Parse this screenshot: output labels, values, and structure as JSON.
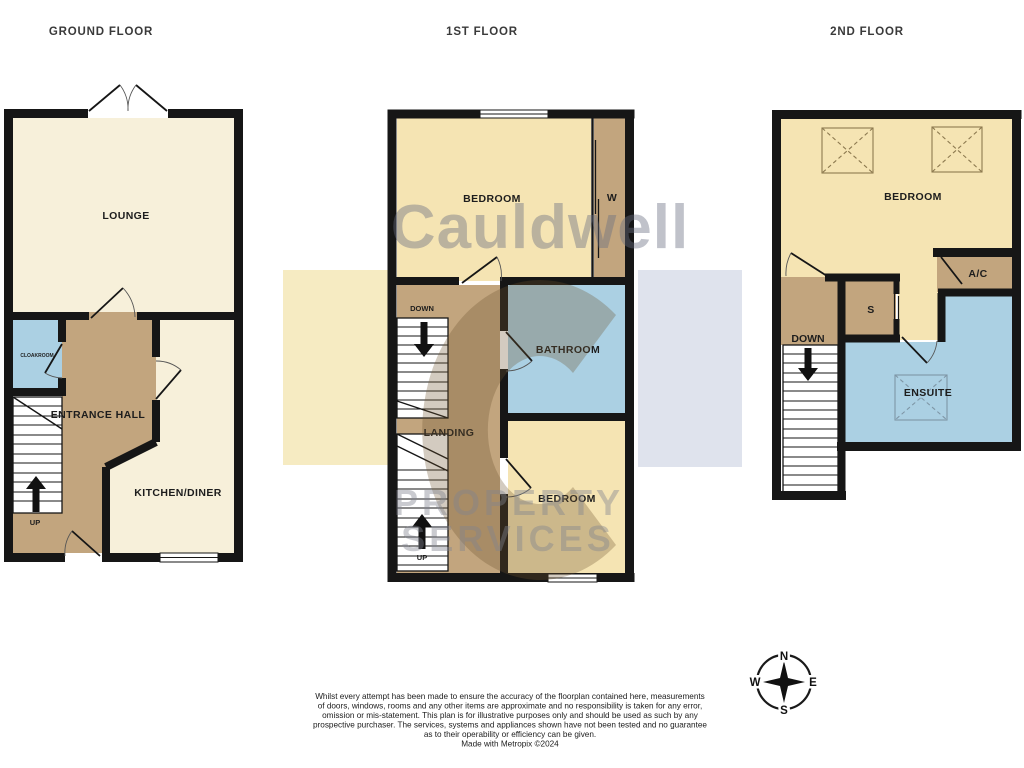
{
  "headers": [
    {
      "label": "GROUND FLOOR"
    },
    {
      "label": "1ST FLOOR"
    },
    {
      "label": "2ND FLOOR"
    }
  ],
  "ground_floor": {
    "lounge": "LOUNGE",
    "cloakroom": "CLOAKROOM",
    "entrance_hall": "ENTRANCE HALL",
    "kitchen_diner": "KITCHEN/DINER",
    "stairs_up": "UP"
  },
  "first_floor": {
    "bedroom_front": "BEDROOM",
    "wardrobe": "W",
    "stairs_down": "DOWN",
    "bathroom": "BATHROOM",
    "landing": "LANDING",
    "bedroom_rear": "BEDROOM",
    "stairs_up": "UP"
  },
  "second_floor": {
    "bedroom": "BEDROOM",
    "air_conditioning": "A/C",
    "store": "S",
    "stairs_down": "DOWN",
    "ensuite": "ENSUITE"
  },
  "watermark": {
    "brand": "Cauldwell",
    "word_top": "PROPERTY",
    "word_bottom": "SERVICES"
  },
  "compass": {
    "north": "N",
    "east": "E",
    "south": "S",
    "west": "W"
  },
  "disclaimer": {
    "lines": [
      "Whilst every attempt has been made to ensure the accuracy of the floorplan contained here, measurements",
      "of doors, windows, rooms and any other items are approximate and no responsibility is taken for any error,",
      "omission or mis-statement. This plan is for illustrative purposes only and should be used as such by any",
      "prospective purchaser. The services, systems and appliances shown have not been tested and no guarantee",
      "as to their operability or efficiency can be given.",
      "Made with Metropix ©2024"
    ]
  },
  "colors": {
    "wall": "#161616",
    "room_cream": "#f7f0da",
    "room_yellow": "#f5e4b3",
    "hall_tan": "#c2a57e",
    "wet_blue": "#abd0e3",
    "stair_white": "#ffffff",
    "watermark_yellow": "#f6ebc2",
    "watermark_blue": "#dfe3ed"
  }
}
